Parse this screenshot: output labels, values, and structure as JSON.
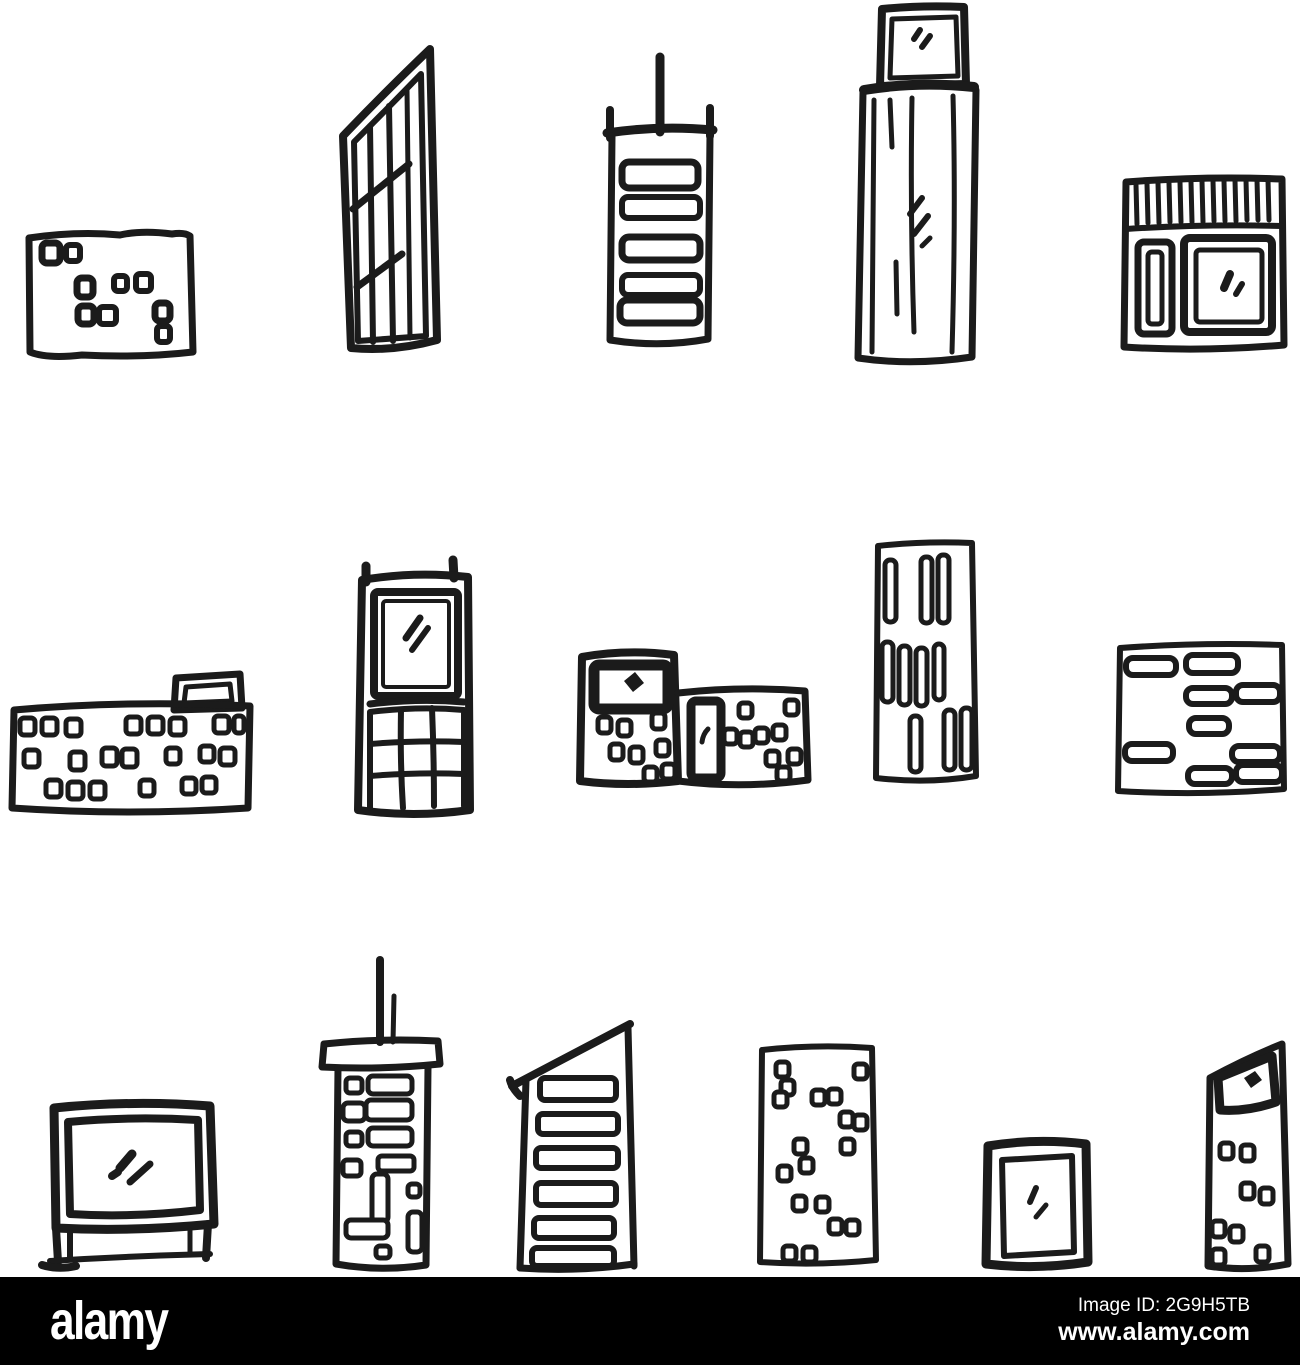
{
  "image": {
    "kind": "hand-drawn doodle sketch set of city buildings, black ink on white",
    "ink_color": "#1b1b1b",
    "background_color": "#ffffff"
  },
  "buildings": [
    {
      "id": "square-office-scattered-windows",
      "row": 1
    },
    {
      "id": "slanted-glass-tower",
      "row": 1
    },
    {
      "id": "antenna-tower-window-bands",
      "row": 1
    },
    {
      "id": "skyscraper-rooftop-cabin",
      "row": 1
    },
    {
      "id": "shop-striped-awning",
      "row": 1
    },
    {
      "id": "wide-low-rise-rooftop-access",
      "row": 2
    },
    {
      "id": "tower-glass-top-grid-base",
      "row": 2
    },
    {
      "id": "two-block-building-entrance",
      "row": 2
    },
    {
      "id": "slab-tower-vertical-slits",
      "row": 2
    },
    {
      "id": "office-block-horizontal-windows",
      "row": 2
    },
    {
      "id": "big-window-pavilion",
      "row": 3
    },
    {
      "id": "antenna-apartment-tower",
      "row": 3
    },
    {
      "id": "slant-roof-striped-tower",
      "row": 3
    },
    {
      "id": "tall-block-scattered-windows",
      "row": 3
    },
    {
      "id": "doorway-kiosk",
      "row": 3
    },
    {
      "id": "wedge-top-tower",
      "row": 3
    }
  ],
  "footer": {
    "bar_color": "#000000",
    "logo": "alamy",
    "image_id": "Image ID: 2G9H5TB",
    "url": "www.alamy.com"
  }
}
